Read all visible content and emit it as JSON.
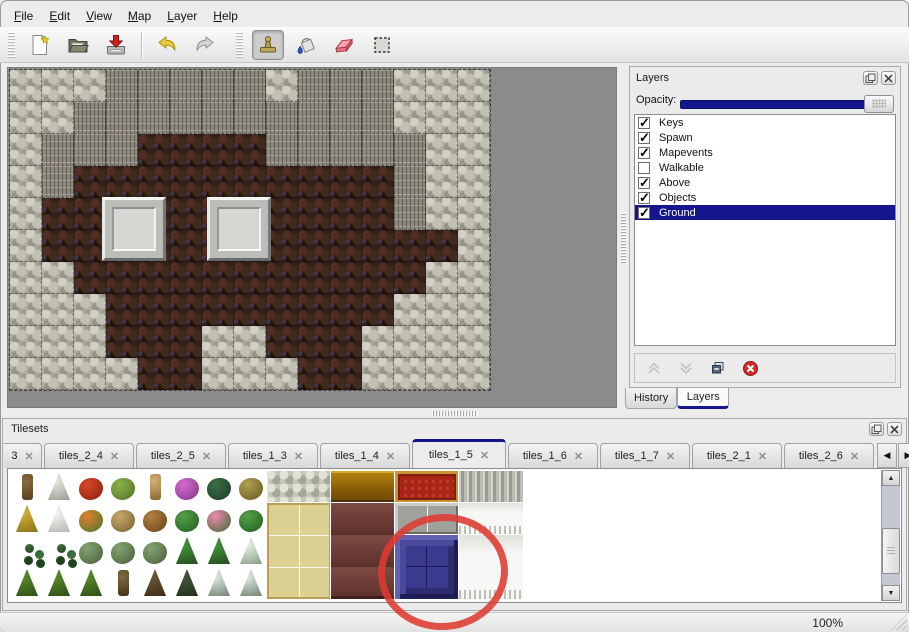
{
  "menu": {
    "items": [
      {
        "label": "File"
      },
      {
        "label": "Edit"
      },
      {
        "label": "View"
      },
      {
        "label": "Map"
      },
      {
        "label": "Layer"
      },
      {
        "label": "Help"
      }
    ]
  },
  "toolbar": {
    "icons": [
      "new-file-icon",
      "open-file-icon",
      "save-file-icon",
      "undo-icon",
      "redo-icon",
      "stamp-tool-icon",
      "fill-tool-icon",
      "eraser-tool-icon",
      "select-tool-icon"
    ],
    "active_tool": "stamp"
  },
  "map": {
    "tile_size": 32,
    "rows": [
      "SSSCCCCCSCCCSSS",
      "SSCCCCCCCCCCSSS",
      "SCCCFFFFCCCCCSS",
      "SCFFFFFFFFFFCSS",
      "SFFFFFFFFFFFCSS",
      "SFFFFFFFFFFFFFS",
      "SSFFFFFFFFFFFSS",
      "SSSFFFFFFFFFSSS",
      "SSSFFFSSFFFSSSS",
      "SSSSFFSSSFFSSSS"
    ],
    "legend": {
      "S": "light-rock",
      "C": "cliff",
      "F": "cave-floor"
    },
    "panels": [
      {
        "x": 92,
        "y": 127
      },
      {
        "x": 197,
        "y": 127
      }
    ]
  },
  "layers_panel": {
    "title": "Layers",
    "opacity_label": "Opacity:",
    "opacity_percent": 100,
    "selection_color": "#15158d",
    "layers": [
      {
        "name": "Keys",
        "checked": true,
        "selected": false
      },
      {
        "name": "Spawn",
        "checked": true,
        "selected": false
      },
      {
        "name": "Mapevents",
        "checked": true,
        "selected": false
      },
      {
        "name": "Walkable",
        "checked": false,
        "selected": false
      },
      {
        "name": "Above",
        "checked": true,
        "selected": false
      },
      {
        "name": "Objects",
        "checked": true,
        "selected": false
      },
      {
        "name": "Ground",
        "checked": true,
        "selected": true
      }
    ],
    "buttons": [
      {
        "name": "move-layer-up",
        "enabled": false
      },
      {
        "name": "move-layer-down",
        "enabled": false
      },
      {
        "name": "duplicate-layer",
        "enabled": true
      },
      {
        "name": "delete-layer",
        "enabled": true
      }
    ],
    "tabs": [
      {
        "label": "History",
        "active": false
      },
      {
        "label": "Layers",
        "active": true
      }
    ]
  },
  "tilesets_panel": {
    "title": "Tilesets",
    "tabs": [
      {
        "label": "3",
        "clipped": true,
        "active": false
      },
      {
        "label": "tiles_2_4",
        "active": false
      },
      {
        "label": "tiles_2_5",
        "active": false
      },
      {
        "label": "tiles_1_3",
        "active": false
      },
      {
        "label": "tiles_1_4",
        "active": false
      },
      {
        "label": "tiles_1_5",
        "active": true
      },
      {
        "label": "tiles_1_6",
        "active": false
      },
      {
        "label": "tiles_1_7",
        "active": false
      },
      {
        "label": "tiles_2_1",
        "active": false
      },
      {
        "label": "tiles_2_6",
        "active": false
      }
    ],
    "close_glyph": "✕",
    "scroll_left_glyph": "◀",
    "scroll_right_glyph": "▶",
    "palette": {
      "tile_size": 32,
      "nature_rows": [
        [
          "trunk",
          "whitetree",
          "redflower",
          "stump",
          "tantrunk",
          "purpleflower",
          "fern",
          "dryplant"
        ],
        [
          "hay",
          "snowmound",
          "orangeflower",
          "drygrass",
          "leaves",
          "lily",
          "pinkflower",
          "lily"
        ],
        [
          "specks",
          "specks",
          "bush",
          "bush",
          "bush",
          "palm",
          "palm",
          "snowtree"
        ],
        [
          "conifer",
          "conifer",
          "conifer",
          "twist",
          "deadtree",
          "darktree",
          "snowpine",
          "snowpine"
        ]
      ],
      "tokens": {
        "trunk": {
          "c1": "#8a6a3c",
          "c2": "#54401e",
          "shape": "trunk"
        },
        "whitetree": {
          "c1": "#eceae2",
          "c2": "#96968c",
          "shape": "tree"
        },
        "redflower": {
          "c1": "#d84828",
          "c2": "#871f0e",
          "shape": "round"
        },
        "stump": {
          "c1": "#8cb04c",
          "c2": "#507422",
          "shape": "round"
        },
        "tantrunk": {
          "c1": "#d2b272",
          "c2": "#876730",
          "shape": "trunk"
        },
        "purpleflower": {
          "c1": "#d86ad0",
          "c2": "#7c3884",
          "shape": "round"
        },
        "fern": {
          "c1": "#3c7048",
          "c2": "#1a3a22",
          "shape": "round"
        },
        "dryplant": {
          "c1": "#b0a050",
          "c2": "#665722",
          "shape": "round"
        },
        "hay": {
          "c1": "#d2b238",
          "c2": "#8a6e16",
          "shape": "tree"
        },
        "snowmound": {
          "c1": "#f5f5f1",
          "c2": "#b2b2ae",
          "shape": "tree"
        },
        "orangeflower": {
          "c1": "#e08030",
          "c2": "#47762a",
          "shape": "round"
        },
        "drygrass": {
          "c1": "#c6aa6a",
          "c2": "#766030",
          "shape": "round"
        },
        "leaves": {
          "c1": "#b28242",
          "c2": "#664014",
          "shape": "round"
        },
        "lily": {
          "c1": "#54a048",
          "c2": "#215c21",
          "shape": "round"
        },
        "pinkflower": {
          "c1": "#ee8aae",
          "c2": "#386a30",
          "shape": "round"
        },
        "specks": {
          "c1": "#3c6c3c",
          "c2": "#1e421e",
          "shape": "specks"
        },
        "bush": {
          "c1": "#86a272",
          "c2": "#445f38",
          "shape": "round"
        },
        "palm": {
          "c1": "#4a9240",
          "c2": "#1d4d16",
          "shape": "tree"
        },
        "snowtree": {
          "c1": "#eaf2ea",
          "c2": "#829a82",
          "shape": "tree"
        },
        "conifer": {
          "c1": "#5a8a2e",
          "c2": "#294d12",
          "shape": "tree"
        },
        "twist": {
          "c1": "#7e6a42",
          "c2": "#403016",
          "shape": "trunk"
        },
        "deadtree": {
          "c1": "#6e5a3a",
          "c2": "#382a12",
          "shape": "tree"
        },
        "darktree": {
          "c1": "#46563e",
          "c2": "#1e2e16",
          "shape": "tree"
        },
        "snowpine": {
          "c1": "#e2eae2",
          "c2": "#6c7e6c",
          "shape": "tree"
        }
      },
      "blocks": [
        {
          "x": 8,
          "y": 0,
          "w": 2,
          "h": 1,
          "token": "stone"
        },
        {
          "x": 8,
          "y": 1,
          "w": 2,
          "h": 3,
          "token": "tanmat"
        },
        {
          "x": 10,
          "y": 0,
          "w": 2,
          "h": 1,
          "token": "wood"
        },
        {
          "x": 10,
          "y": 1,
          "w": 2,
          "h": 3,
          "token": "maroon"
        },
        {
          "x": 12,
          "y": 0,
          "w": 2,
          "h": 1,
          "token": "carpet"
        },
        {
          "x": 12,
          "y": 1,
          "w": 2,
          "h": 1,
          "token": "grayblocks"
        },
        {
          "x": 12,
          "y": 2,
          "w": 2,
          "h": 2,
          "token": "bluebutton"
        },
        {
          "x": 14,
          "y": 0,
          "w": 2,
          "h": 1,
          "token": "silvercurtain"
        },
        {
          "x": 14,
          "y": 1,
          "w": 2,
          "h": 1,
          "token": "whitecurtain"
        },
        {
          "x": 14,
          "y": 2,
          "w": 2,
          "h": 2,
          "token": "whitecurtain"
        }
      ]
    }
  },
  "annotation": {
    "shape": "hand-drawn-ellipse",
    "color": "#de3a30",
    "highlights": "blue button tile in palette"
  },
  "status": {
    "zoom": "100%"
  }
}
